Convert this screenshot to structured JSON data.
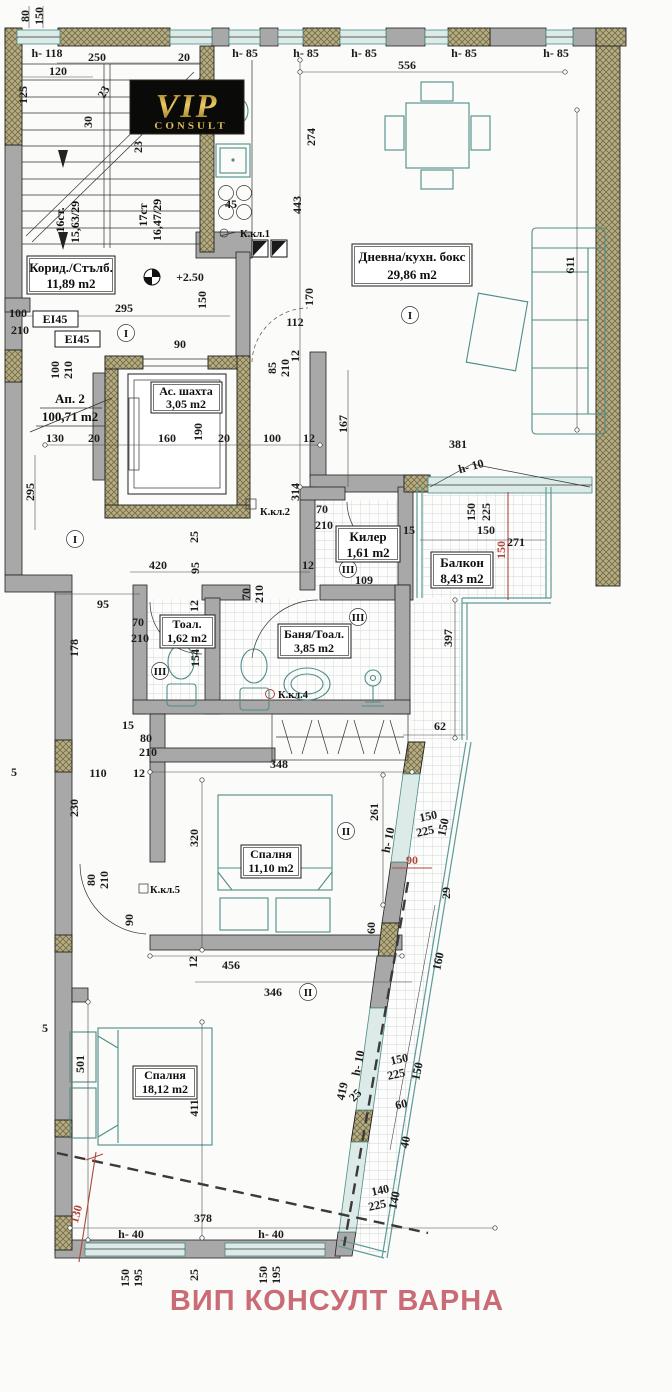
{
  "logo": {
    "vip": "VIP",
    "consult": "CONSULT"
  },
  "footer": {
    "text": "ВИП КОНСУЛТ ВАРНА"
  },
  "apartment": {
    "name": "Ап. 2",
    "area": "100,71 m2"
  },
  "fire_rating": "EI45",
  "rooms": {
    "corridor": {
      "name": "Корид./Стълб.",
      "area": "11,89 m2"
    },
    "living": {
      "name": "Дневна/кухн. бокс",
      "area": "29,86 m2"
    },
    "shaft": {
      "name": "Ас. шахта",
      "area": "3,05 m2"
    },
    "storage": {
      "name": "Килер",
      "area": "1,61 m2"
    },
    "balcony": {
      "name": "Балкон",
      "area": "8,43 m2"
    },
    "wc": {
      "name": "Тоал.",
      "area": "1,62 m2"
    },
    "bath": {
      "name": "Баня/Тоал.",
      "area": "3,85 m2"
    },
    "bedroom1": {
      "name": "Спалня",
      "area": "11,10 m2"
    },
    "bedroom2": {
      "name": "Спалня",
      "area": "18,12 m2"
    }
  },
  "stairs": {
    "up_flight": "16ст.",
    "up_calc": "15,63/29",
    "down_flight": "17ст",
    "down_calc": "16,47/29"
  },
  "keys": {
    "k1": "К.кл.1",
    "k2": "К.кл.2",
    "k4": "К.кл.4",
    "k5": "К.кл.5"
  },
  "zones": {
    "z1": "I",
    "z2": "II",
    "z3": "III"
  },
  "dims": [
    "80",
    "150",
    "h- 118",
    "250",
    "120",
    "20",
    "125",
    "23",
    "30",
    "23",
    "h- 85",
    "h- 85",
    "h- 85",
    "h- 85",
    "h- 85",
    "556",
    "274",
    "443",
    "45",
    "+2.50",
    "295",
    "150",
    "100",
    "210",
    "112",
    "90",
    "100",
    "210",
    "85",
    "210",
    "12",
    "170",
    "167",
    "611",
    "130",
    "20",
    "160",
    "190",
    "20",
    "100",
    "12",
    "295",
    "314",
    "420",
    "95",
    "25",
    "12",
    "70",
    "210",
    "15",
    "150",
    "225",
    "150",
    "271",
    "381",
    "h- 10",
    "397",
    "95",
    "178",
    "70",
    "210",
    "12",
    "154",
    "70",
    "210",
    "62",
    "15",
    "80",
    "210",
    "110",
    "12",
    "5",
    "230",
    "348",
    "320",
    "261",
    "h- 10",
    "60",
    "90",
    "29",
    "160",
    "80",
    "210",
    "90",
    "456",
    "12",
    "346",
    "501",
    "411",
    "5",
    "150",
    "225",
    "150",
    "419",
    "25",
    "h- 10",
    "60",
    "40",
    "140",
    "225",
    "140",
    "130",
    "378",
    "h- 40",
    "h- 40",
    "150",
    "195",
    "25",
    "150",
    "195",
    "150",
    "109",
    "150",
    "225",
    "150"
  ]
}
